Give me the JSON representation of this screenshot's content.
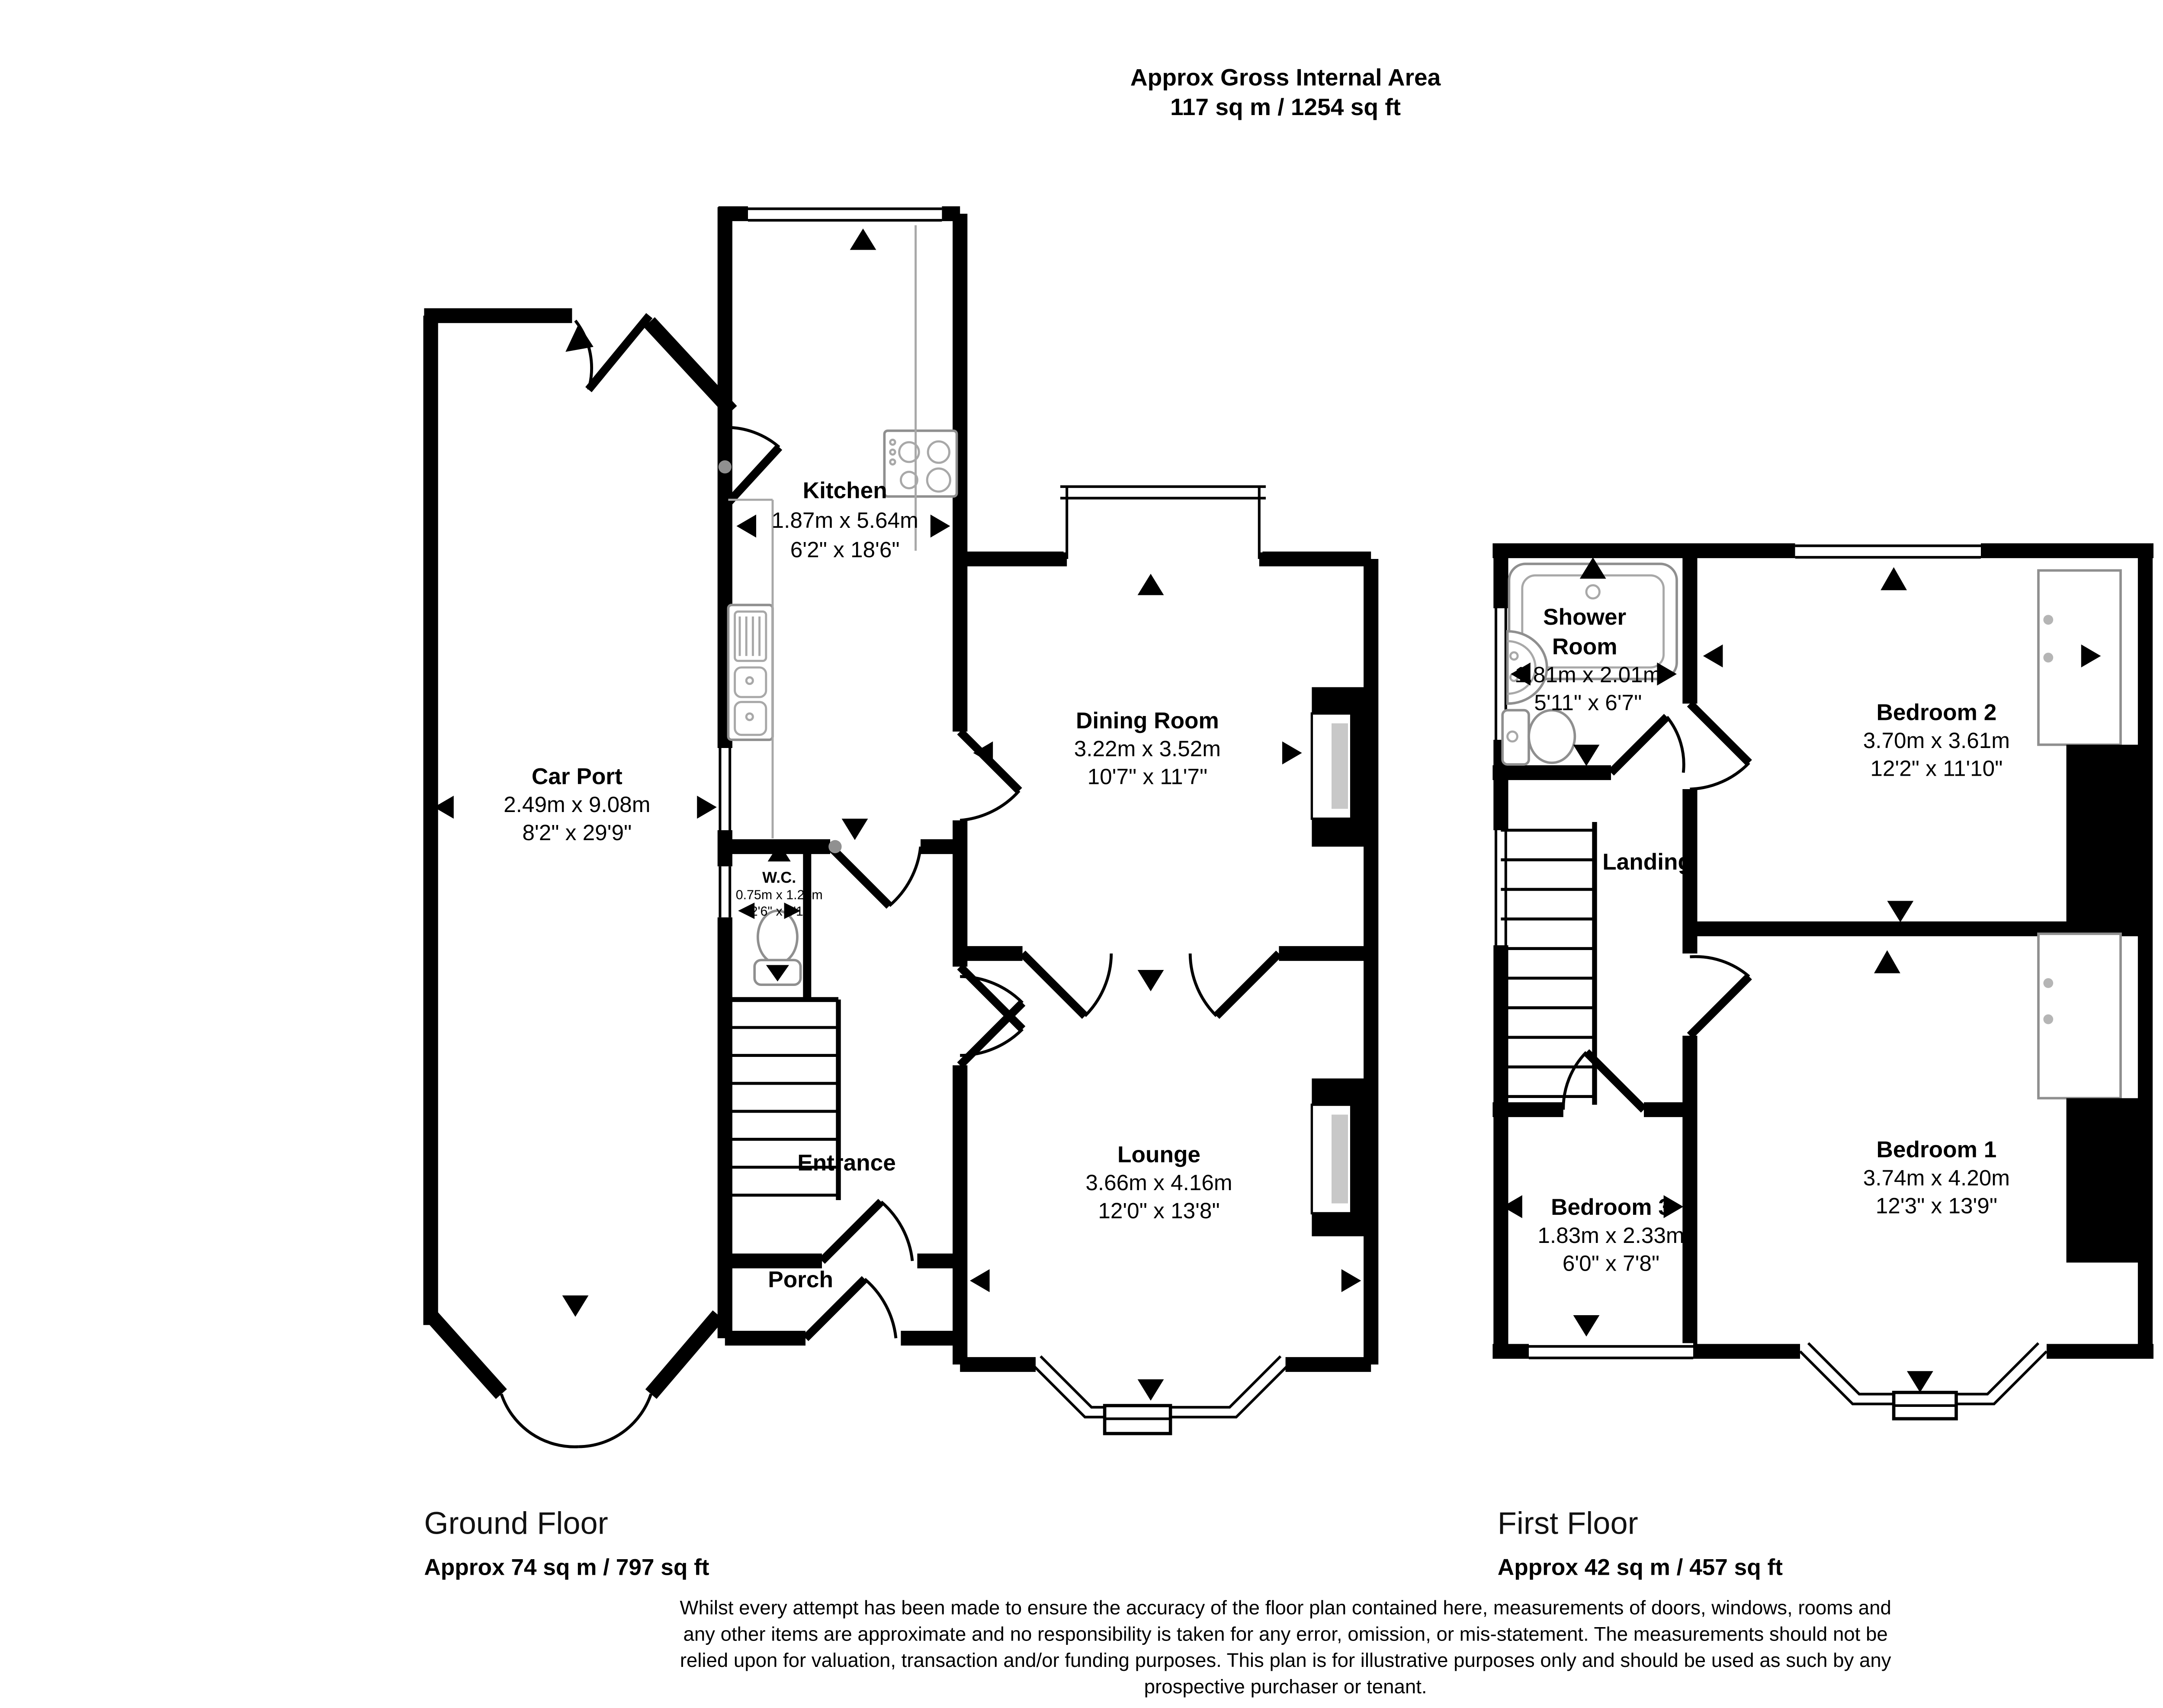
{
  "title": {
    "line1": "Approx Gross Internal Area",
    "line2": "117 sq m / 1254 sq ft"
  },
  "compass": {
    "n": "N",
    "e": "E",
    "s": "S",
    "w": "W"
  },
  "ground_floor": {
    "label": "Ground Floor",
    "area": "Approx 74 sq m / 797 sq ft",
    "rooms": {
      "car_port": {
        "name": "Car Port",
        "metric": "2.49m x 9.08m",
        "imperial": "8'2\" x 29'9\""
      },
      "kitchen": {
        "name": "Kitchen",
        "metric": "1.87m x 5.64m",
        "imperial": "6'2\" x 18'6\""
      },
      "dining_room": {
        "name": "Dining Room",
        "metric": "3.22m x 3.52m",
        "imperial": "10'7\" x 11'7\""
      },
      "wc": {
        "name": "W.C.",
        "metric": "0.75m x 1.24m",
        "imperial": "2'6\" x 4'1\""
      },
      "entrance": {
        "name": "Entrance"
      },
      "porch": {
        "name": "Porch"
      },
      "lounge": {
        "name": "Lounge",
        "metric": "3.66m x 4.16m",
        "imperial": "12'0\" x 13'8\""
      }
    }
  },
  "first_floor": {
    "label": "First Floor",
    "area": "Approx 42 sq m / 457 sq ft",
    "rooms": {
      "shower_room": {
        "name_line1": "Shower",
        "name_line2": "Room",
        "metric": "1.81m x 2.01m",
        "imperial": "5'11\" x 6'7\""
      },
      "bedroom2": {
        "name": "Bedroom 2",
        "metric": "3.70m x 3.61m",
        "imperial": "12'2\" x 11'10\""
      },
      "landing": {
        "name": "Landing"
      },
      "bedroom3": {
        "name": "Bedroom 3",
        "metric": "1.83m x 2.33m",
        "imperial": "6'0\" x 7'8\""
      },
      "bedroom1": {
        "name": "Bedroom 1",
        "metric": "3.74m x 4.20m",
        "imperial": "12'3\" x 13'9\""
      }
    }
  },
  "disclaimer": {
    "line1": "Whilst every attempt has been made to ensure the accuracy of the floor plan contained here, measurements of doors, windows, rooms and",
    "line2": "any other items are approximate and no responsibility is taken for any error, omission, or mis-statement. The measurements should not be",
    "line3": "relied upon for valuation, transaction and/or funding purposes. This plan is for illustrative purposes only and should be used as such by any",
    "line4": "prospective purchaser or tenant."
  }
}
